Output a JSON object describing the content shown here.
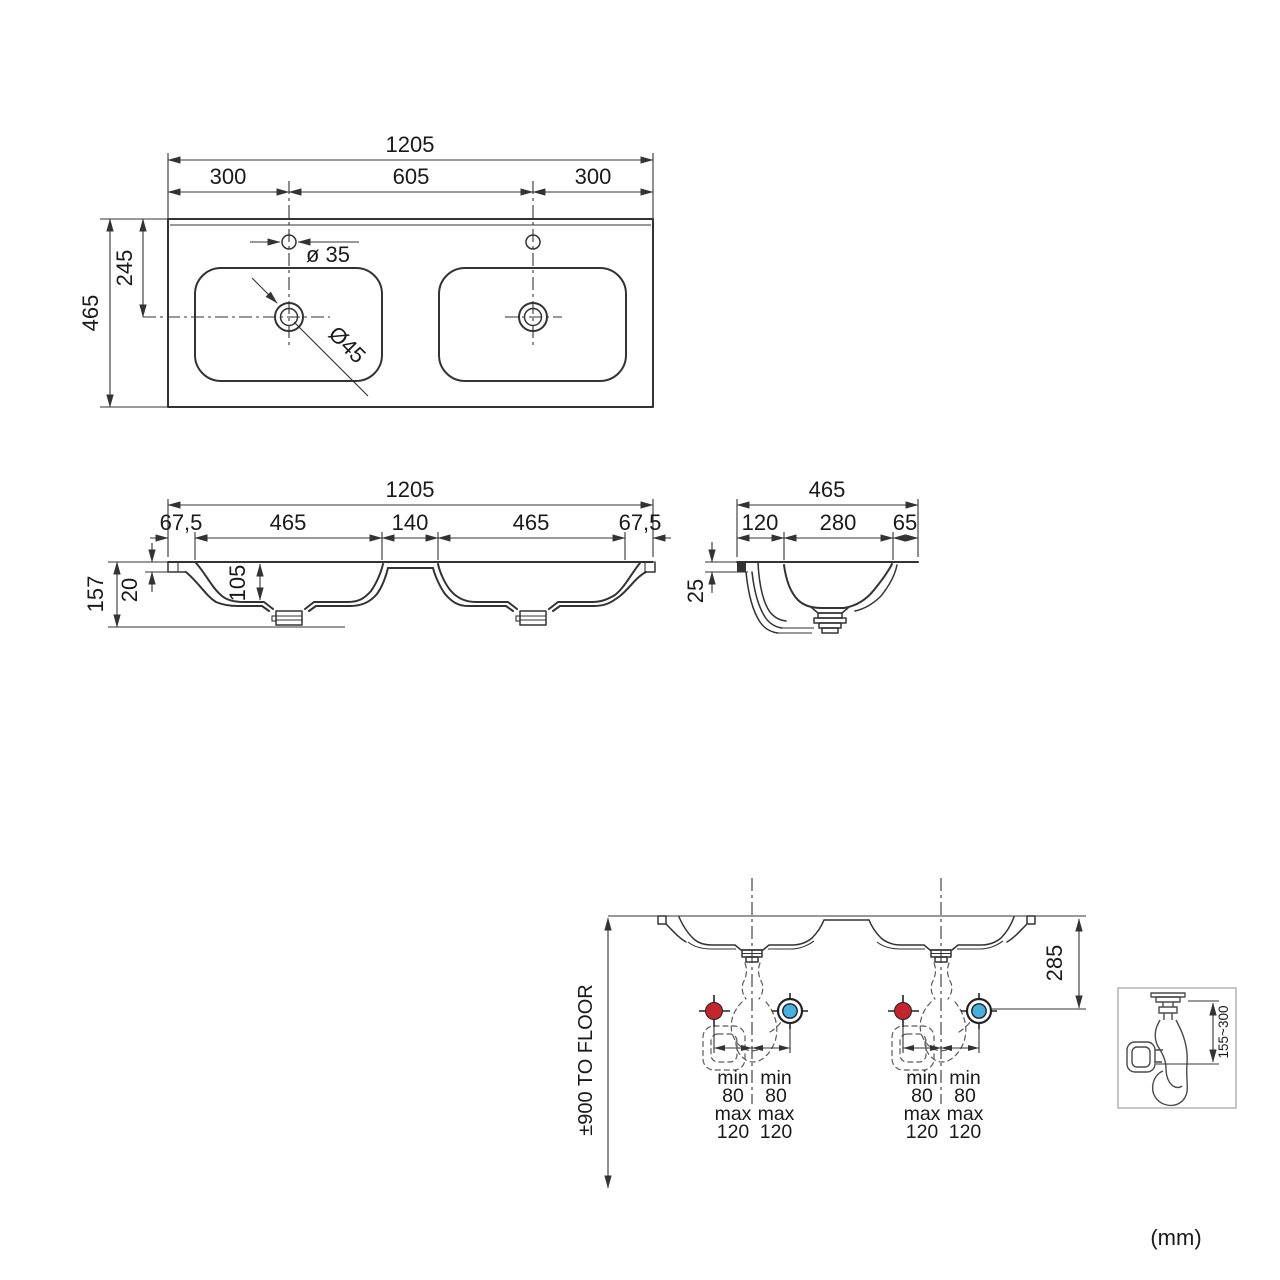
{
  "units_note": "(mm)",
  "colors": {
    "hot_supply": "#c4242b",
    "cold_supply": "#45b1e0",
    "line": "#333333"
  },
  "top_view": {
    "overall_width": "1205",
    "left_hole_offset": "300",
    "hole_spacing": "605",
    "right_hole_offset": "300",
    "overall_depth": "465",
    "drain_center_offset": "245",
    "faucet_hole_diameter": "ø 35",
    "drain_diameter": "Ø45"
  },
  "front_view": {
    "overall_width": "1205",
    "left_rim": "67,5",
    "left_basin": "465",
    "center_divider": "140",
    "right_basin": "465",
    "right_rim": "67,5",
    "overall_height": "157",
    "countertop_thickness": "20",
    "basin_depth": "105"
  },
  "side_view": {
    "overall_depth": "465",
    "front_rim": "120",
    "basin_opening": "280",
    "back_rim": "65",
    "edge_thickness": "25"
  },
  "installation_view": {
    "height_note": "±900 TO FLOOR",
    "drain_drop": "285",
    "supply": {
      "min_label": "min",
      "min_value": "80",
      "max_label": "max",
      "max_value": "120"
    },
    "trap_detail": {
      "adjust_range": "155~300"
    }
  }
}
